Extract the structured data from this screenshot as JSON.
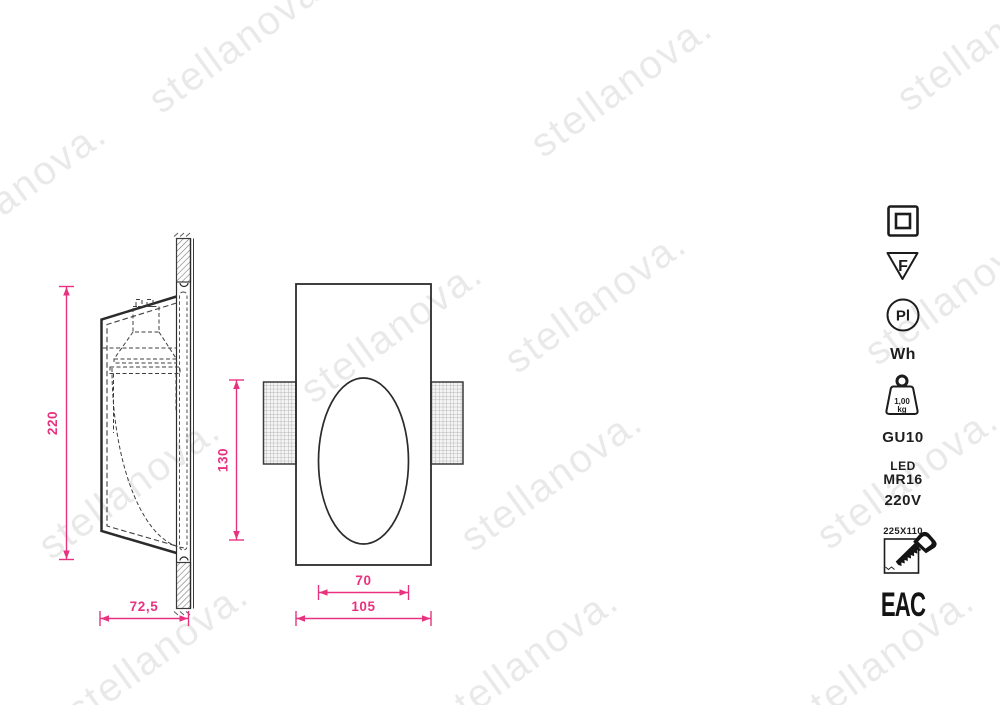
{
  "meta": {
    "accent_pink": "#e8327f",
    "line_color": "#2b2b2b",
    "background": "#ffffff"
  },
  "watermark": {
    "text": "stellanova."
  },
  "drawing": {
    "side_view": {
      "name": "side-section-view",
      "dim_height": "220",
      "dim_depth": "72,5"
    },
    "front_view": {
      "name": "front-view",
      "dim_opening_height": "130",
      "dim_opening_width": "70",
      "dim_width": "105"
    }
  },
  "spec_panel": {
    "class2_icon": "class-ii-double-square",
    "f_mark": "F",
    "pi_mark": "Pl",
    "finish": "Wh",
    "weight_value": "1,00",
    "weight_unit": "kg",
    "socket": "GU10",
    "lamp_line1": "LED",
    "lamp_line2": "MR16",
    "voltage": "220V",
    "cutout_size": "225X110",
    "certification": "EAC"
  }
}
